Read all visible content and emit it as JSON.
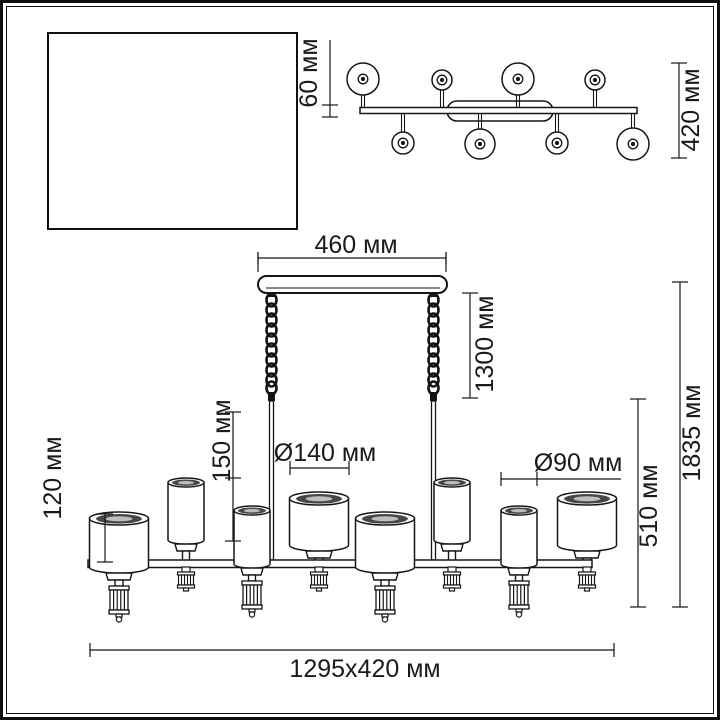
{
  "inset": {
    "bracket_length": "360 мм",
    "bracket_caption_line1": "крепежная",
    "bracket_caption_line2": "планка",
    "plate_height": "60 мм",
    "plate_width": "460 мм"
  },
  "top_view": {
    "stem_offset": "60 мм",
    "fixture_depth": "420 мм"
  },
  "front_view": {
    "canopy_width": "460 мм",
    "chain_length": "1300 мм",
    "small_shade_height": "150 мм",
    "large_shade_height": "120 мм",
    "large_shade_diameter": "Ø140 мм",
    "small_shade_diameter": "Ø90 мм",
    "body_height": "510 мм",
    "total_height": "1835 мм",
    "overall_size": "1295x420 мм"
  },
  "colors": {
    "line": "#161616",
    "background": "#ffffff"
  }
}
